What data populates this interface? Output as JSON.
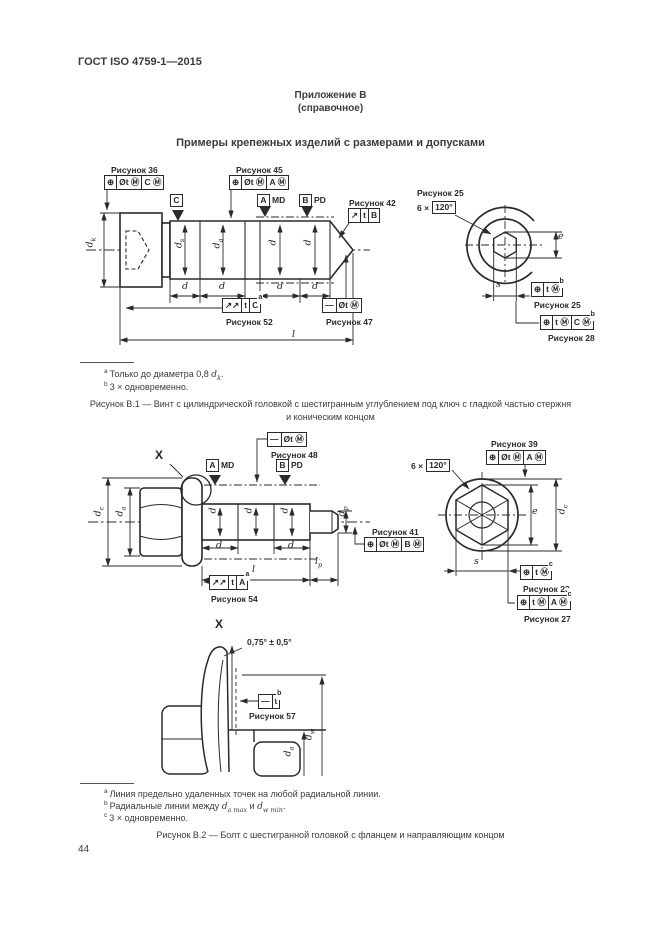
{
  "page": {
    "header": "ГОСТ ISO 4759-1—2015",
    "appendix": "Приложение В",
    "appendix_note": "(справочное)",
    "title": "Примеры крепежных изделий с размерами и допусками",
    "page_number": "44"
  },
  "b1": {
    "frames": {
      "f36": {
        "label": "Рисунок 36",
        "c0": "⊕",
        "c1": "Øt Ⓜ",
        "c2": "C Ⓜ",
        "sup": ""
      },
      "f45": {
        "label": "Рисунок 45",
        "c0": "⊕",
        "c1": "Øt Ⓜ",
        "c2": "A Ⓜ",
        "sup": ""
      },
      "f42": {
        "label": "Рисунок 42",
        "c0": "↗",
        "c1": "t",
        "c2": "B",
        "sup": ""
      },
      "f52": {
        "label": "Рисунок 52",
        "c0": "↗↗",
        "c1": "t",
        "c2": "C",
        "sup": "a"
      },
      "f47": {
        "label": "Рисунок 47",
        "c0": "—",
        "c1": "Øt Ⓜ",
        "sup": ""
      },
      "f25": {
        "label": "Рисунок 25",
        "c0": "⊕",
        "c1": "t Ⓜ",
        "sup": "b"
      },
      "f28": {
        "label": "Рисунок 28",
        "c0": "⊕",
        "c1": "t Ⓜ",
        "c2": "C Ⓜ",
        "sup": "b"
      }
    },
    "angle": {
      "label": "Рисунок 25",
      "prefix": "6 ×",
      "value": "120°"
    },
    "datums": {
      "c": "C",
      "a": "A",
      "md": "MD",
      "b": "B",
      "pd": "PD"
    },
    "dims": {
      "dk": {
        "b": "d",
        "s": "k"
      },
      "ds": {
        "b": "d",
        "s": "s"
      },
      "da": {
        "b": "d",
        "s": "a"
      },
      "d": {
        "b": "d",
        "s": ""
      },
      "l": {
        "b": "l",
        "s": ""
      },
      "e": {
        "b": "e",
        "s": ""
      },
      "s": {
        "b": "s",
        "s": ""
      }
    },
    "footnotes": [
      {
        "sup": "a",
        "pre": "Только до диаметра 0,8 ",
        "v": "d",
        "vs": "k",
        "mid": "",
        "v2": "",
        "vs2": "",
        "post": "."
      },
      {
        "sup": "b",
        "pre": "3 × одновременно.",
        "v": "",
        "vs": "",
        "mid": "",
        "v2": "",
        "vs2": "",
        "post": ""
      }
    ],
    "caption1": "Рисунок В.1 — Винт с цилиндрической головкой с шестигранным углублением под ключ с гладкой частью стержня",
    "caption2": "и коническим концом"
  },
  "b2": {
    "frames": {
      "f48": {
        "label": "Рисунок 48",
        "c0": "—",
        "c1": "Øt Ⓜ",
        "sup": ""
      },
      "f39": {
        "label": "Рисунок 39",
        "c0": "⊕",
        "c1": "Øt Ⓜ",
        "c2": "A Ⓜ",
        "sup": ""
      },
      "f41": {
        "label": "Рисунок 41",
        "c0": "⊕",
        "c1": "Øt Ⓜ",
        "c2": "B Ⓜ",
        "sup": ""
      },
      "f54": {
        "label": "Рисунок 54",
        "c0": "↗↗",
        "c1": "t",
        "c2": "A",
        "sup": "a"
      },
      "f23": {
        "label": "Рисунок 23",
        "c0": "⊕",
        "c1": "t Ⓜ",
        "sup": "c"
      },
      "f27": {
        "label": "Рисунок 27",
        "c0": "⊕",
        "c1": "t Ⓜ",
        "c2": "A Ⓜ",
        "sup": "c"
      },
      "f57": {
        "label": "Рисунок 57",
        "c0": "—",
        "c1": "t",
        "sup": "b"
      }
    },
    "angle": {
      "prefix": "6 ×",
      "value": "120°"
    },
    "datums": {
      "a": "A",
      "md": "MD",
      "b": "B",
      "pd": "PD"
    },
    "detail": {
      "marker": "X",
      "angle_text": "0,75° ± 0,5°"
    },
    "dims": {
      "dc": {
        "b": "d",
        "s": "c"
      },
      "da": {
        "b": "d",
        "s": "a"
      },
      "dw": {
        "b": "d",
        "s": "w"
      },
      "dp": {
        "b": "d",
        "s": "p"
      },
      "d": {
        "b": "d",
        "s": ""
      },
      "l": {
        "b": "l",
        "s": ""
      },
      "lp": {
        "b": "l",
        "s": "p"
      },
      "e": {
        "b": "e",
        "s": ""
      },
      "s": {
        "b": "s",
        "s": ""
      }
    },
    "footnotes": [
      {
        "sup": "a",
        "pre": "Линия предельно удаленных точек на любой радиальной линии.",
        "v": "",
        "vs": "",
        "mid": "",
        "v2": "",
        "vs2": "",
        "post": ""
      },
      {
        "sup": "b",
        "pre": "Радиальные линии между ",
        "v": "d",
        "vs": "a max",
        "mid": " и ",
        "v2": "d",
        "vs2": "w min",
        "post": "."
      },
      {
        "sup": "c",
        "pre": "3 × одновременно.",
        "v": "",
        "vs": "",
        "mid": "",
        "v2": "",
        "vs2": "",
        "post": ""
      }
    ],
    "caption": "Рисунок В.2 — Болт с шестигранной головкой с фланцем и направляющим концом"
  }
}
